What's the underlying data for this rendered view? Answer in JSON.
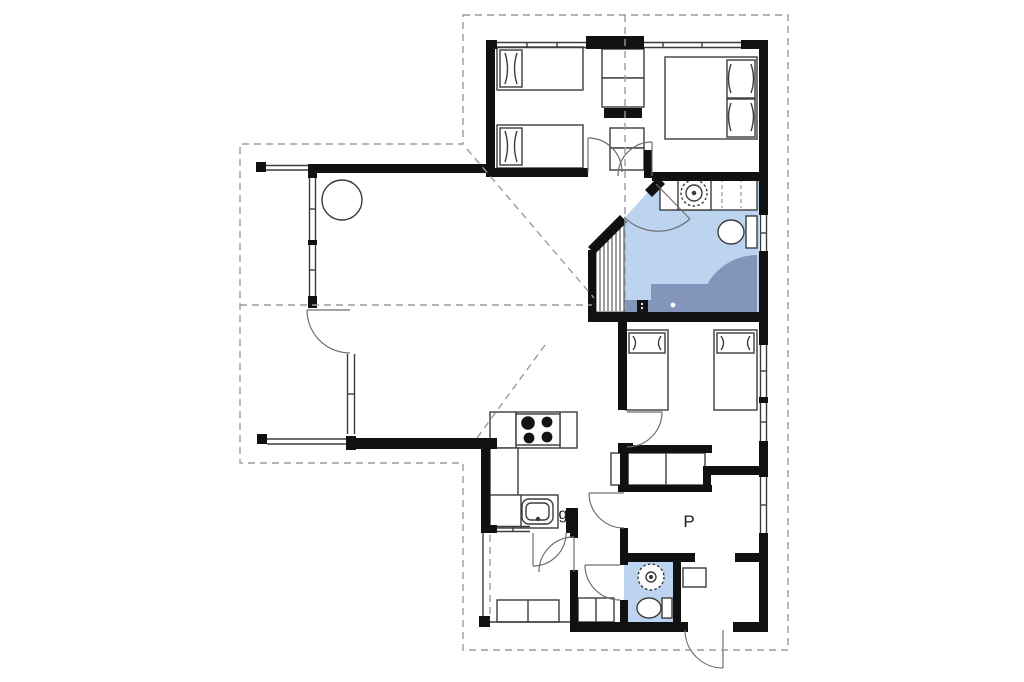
{
  "labels": {
    "kitchen_note": "g",
    "hall_note": "P"
  },
  "colors": {
    "wall": "#111111",
    "furniture_line": "#3c3c3c",
    "door_arc": "#6e6e6e",
    "dashed_line": "#9b9b9b",
    "bathroom_fill": "#bdd4f0",
    "wc_fill": "#bdd4f0",
    "shower_fill": "#8495bb",
    "background": "#ffffff",
    "label_text": "#1b1b1b"
  },
  "icons": {
    "stove-icon": "four filled burner circles",
    "kitchen-sink-icon": "rounded rectangle basin with tap dot",
    "washbasin-icon": "scalloped circle with center dot",
    "toilet-icon": "oval bowl with cistern rectangle",
    "shower-icon": "quarter-round shaded wet zone",
    "single-bed-icon": "rectangle with pillow and side arcs",
    "double-bed-icon": "wide rectangle with two pillows",
    "wardrobe-icon": "divided shelf rectangles",
    "dining-table-icon": "circle",
    "door-icon": "quarter-circle swing arc",
    "window-icon": "double parallel lines in wall"
  }
}
